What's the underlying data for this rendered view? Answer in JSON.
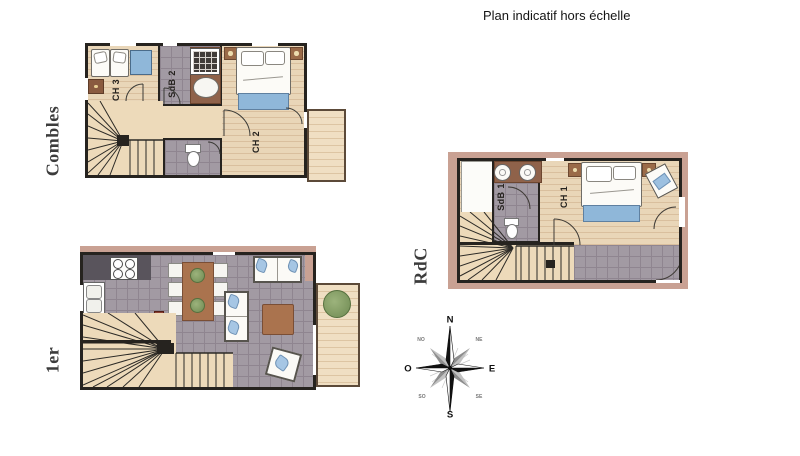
{
  "title": "Plan indicatif hors échelle",
  "floors": {
    "combles": {
      "label": "Combles",
      "rooms": {
        "ch3": "CH 3",
        "sdb2": "SdB 2",
        "ch2": "CH 2"
      }
    },
    "first": {
      "label": "1er"
    },
    "rdc": {
      "label": "RdC",
      "rooms": {
        "sdb1": "SdB 1",
        "ch1": "CH 1"
      }
    }
  },
  "compass": {
    "n": "N",
    "e": "E",
    "s": "S",
    "o": "O",
    "ne": "NE",
    "no": "NO",
    "se": "SE",
    "so": "SO"
  },
  "colors": {
    "wall": "#26231f",
    "wood": "#e9d6b8",
    "woodLine": "#d9bf9e",
    "tile": "#a29aa3",
    "tileLine": "#8f8590",
    "stairTan": "#eddaba",
    "balconyWood": "#f0dfc3",
    "balconyLine": "#ddc5a3",
    "pinkWall": "#c9a193",
    "counter": "#59545c",
    "brown": "#aa734e",
    "bathCounter": "#8f624a",
    "blue": "#8fb7d9",
    "plantGreen": "#7f9a63",
    "labelColor": "#3c3c3c"
  }
}
